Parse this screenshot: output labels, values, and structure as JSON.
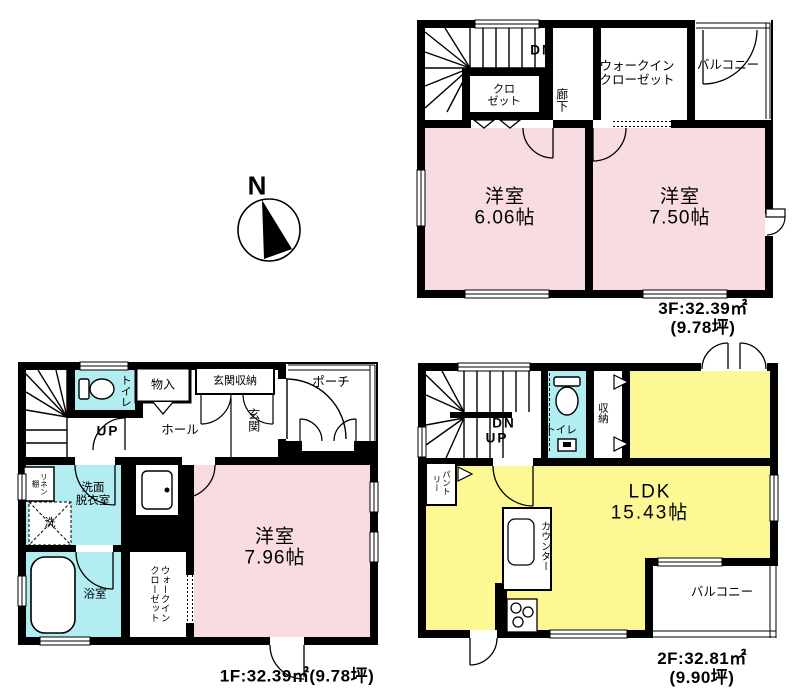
{
  "compass": {
    "north": "N"
  },
  "colors": {
    "room_pink": "#f9dbe2",
    "room_yellow": "#fcf893",
    "room_cyan": "#b2edf2",
    "wall": "#000000"
  },
  "floor3": {
    "area": "3F:32.39㎡(9.78坪)",
    "labels": {
      "dn": "DN",
      "closet": "クロ\nゼット",
      "corridor": "廊下",
      "walk_in_closet": "ウォークイン\nクローゼット",
      "balcony": "バルコニー",
      "room_a": "洋室\n6.06帖",
      "room_b": "洋室\n7.50帖"
    }
  },
  "floor1": {
    "area": "1F:32.39㎡(9.78坪)",
    "labels": {
      "up": "UP",
      "toilet": "トイレ",
      "storage": "物入",
      "entrance_storage": "玄関収納",
      "porch": "ポーチ",
      "entrance": "玄関",
      "hall": "ホール",
      "linen_shelf": "リネン棚",
      "washroom": "洗面\n脱衣室",
      "washer": "洗",
      "bathroom": "浴室",
      "walk_in_closet": "ウォークインクローゼット",
      "room": "洋室\n7.96帖"
    }
  },
  "floor2": {
    "area": "2F:32.81㎡(9.90坪)",
    "labels": {
      "dn": "DN",
      "up": "UP",
      "toilet": "トイレ",
      "storage": "収納",
      "pantry": "パントリー",
      "ldk": "LDK\n15.43帖",
      "counter": "カウンター",
      "balcony": "バルコニー"
    }
  }
}
